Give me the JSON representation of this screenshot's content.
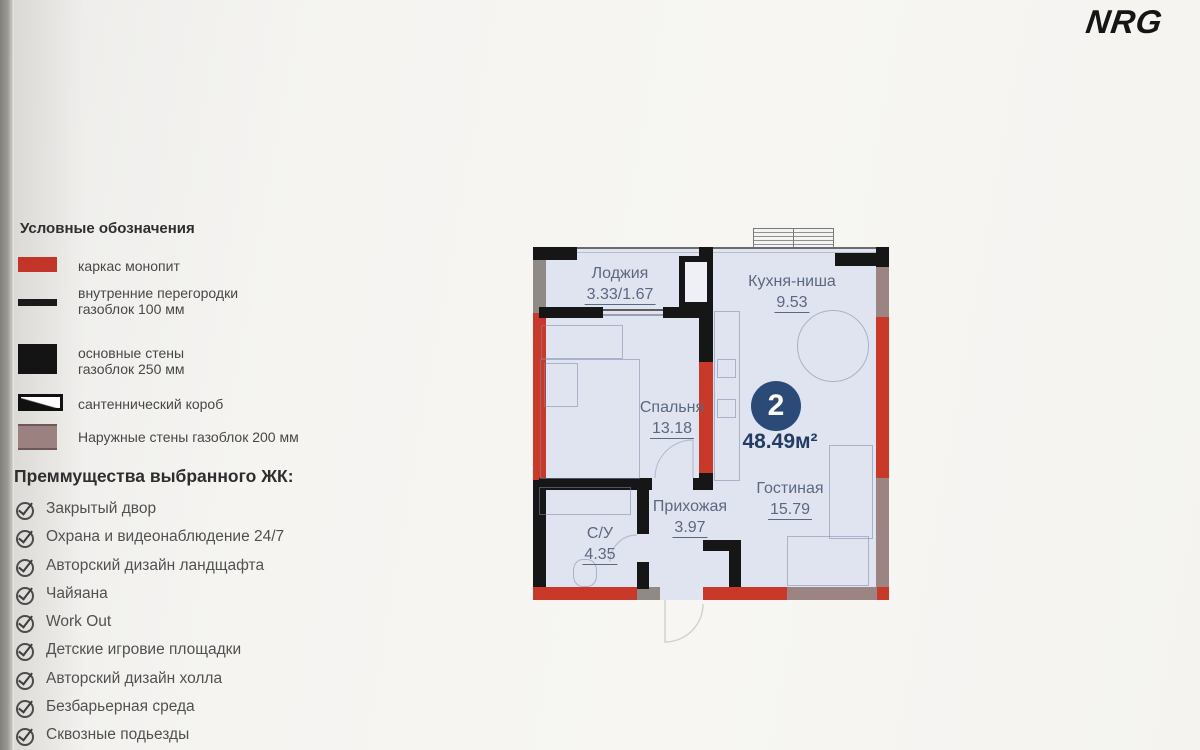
{
  "brand": {
    "logo": "NRG"
  },
  "legend": {
    "title": "Условные обозначения",
    "items": [
      {
        "icon": "red-solid-swatch",
        "color": "#c23528",
        "line1": "каркас монопит",
        "line2": ""
      },
      {
        "icon": "thin-bar-swatch",
        "color": "#1a1a1a",
        "line1": "внутренние перегородки",
        "line2": "газоблок 100 мм"
      },
      {
        "icon": "black-solid-swatch",
        "color": "#141414",
        "line1": "основные стены",
        "line2": "газоблок 250 мм"
      },
      {
        "icon": "outlined-box-swatch",
        "color": "#ffffff",
        "line1": "сантеннический короб",
        "line2": ""
      },
      {
        "icon": "mauve-solid-swatch",
        "color": "#9b8280",
        "line1": "Наружные стены газоблок 200 мм",
        "line2": ""
      }
    ]
  },
  "benefits": {
    "title": "Преммущества выбранного ЖК:",
    "check_icon": "circled-checkmark-icon",
    "items": [
      "Закрытый двор",
      "Охрана и видеонаблюдение 24/7",
      "Авторский дизайн ландщафта",
      "Чайяана",
      "Work Out",
      "Детские игровие площадки",
      "Авторский дизайн холла",
      "Безбарьерная среда",
      "Сквозные подьезды"
    ]
  },
  "floorplan": {
    "badge": {
      "rooms": "2",
      "total_area": "48.49м²"
    },
    "rooms": [
      {
        "name": "Лоджия",
        "area": "3.33/1.67"
      },
      {
        "name": "Кухня-ниша",
        "area": "9.53"
      },
      {
        "name": "Спальня",
        "area": "13.18"
      },
      {
        "name": "Гостиная",
        "area": "15.79"
      },
      {
        "name": "Прихожая",
        "area": "3.97"
      },
      {
        "name": "С/У",
        "area": "4.35"
      }
    ],
    "colors": {
      "frame_red": "#c8392a",
      "wall_black": "#161616",
      "outer_mauve": "#9b8482",
      "sanitary_gray": "#8f8a85",
      "floor": "#e0e4f0",
      "accent_navy": "#2c4a78"
    }
  }
}
